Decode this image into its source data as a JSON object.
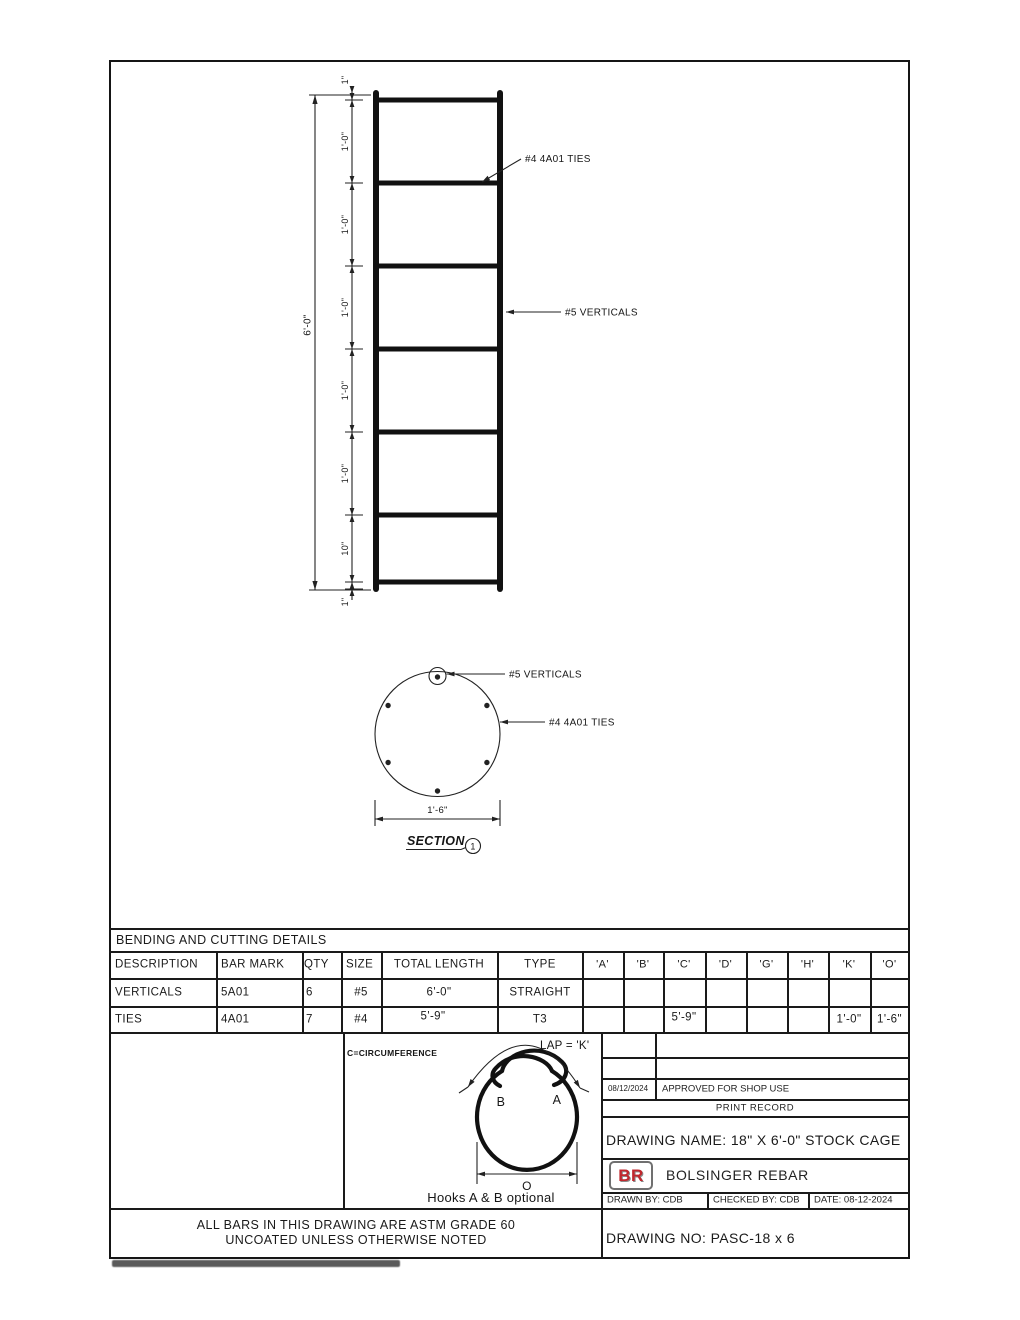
{
  "elevation": {
    "overall_dim": "6'-0\"",
    "dims": [
      "1\"",
      "1'-0\"",
      "1'-0\"",
      "1'-0\"",
      "1'-0\"",
      "1'-0\"",
      "10\"",
      "1\""
    ],
    "ties_label": "#4 4A01 TIES",
    "verticals_label": "#5 VERTICALS"
  },
  "section": {
    "verticals_label": "#5 VERTICALS",
    "ties_label": "#4 4A01 TIES",
    "width_dim": "1'-6\"",
    "title": "SECTION",
    "bubble": "1"
  },
  "bending_table": {
    "title": "BENDING AND CUTTING DETAILS",
    "columns": [
      "DESCRIPTION",
      "BAR MARK",
      "QTY",
      "SIZE",
      "TOTAL LENGTH",
      "TYPE",
      "'A'",
      "'B'",
      "'C'",
      "'D'",
      "'G'",
      "'H'",
      "'K'",
      "'O'"
    ],
    "rows": [
      {
        "desc": "VERTICALS",
        "mark": "5A01",
        "qty": "6",
        "size": "#5",
        "len": "6'-0\"",
        "type": "STRAIGHT"
      },
      {
        "desc": "TIES",
        "mark": "4A01",
        "qty": "7",
        "size": "#4",
        "len": "5'-9\"",
        "type": "T3",
        "c": "5'-9\"",
        "k": "1'-0\"",
        "o": "1'-6\""
      }
    ]
  },
  "hook_detail": {
    "circumference_note": "C=CIRCUMFERENCE",
    "lap_label": "LAP = 'K'",
    "hook_b": "B",
    "hook_a": "A",
    "diameter_label": "O",
    "caption": "Hooks A & B optional"
  },
  "title_block": {
    "print_record": {
      "date": "08/12/2024",
      "note": "APPROVED FOR SHOP USE",
      "label": "PRINT RECORD"
    },
    "drawing_name": "DRAWING NAME: 18\" X 6'-0\" STOCK CAGE",
    "logo_text": "BR",
    "company": "BOLSINGER REBAR",
    "drawn_by": "DRAWN BY: CDB",
    "checked_by": "CHECKED BY: CDB",
    "date": "DATE: 08-12-2024",
    "drawing_no": "DRAWING NO: PASC-18 x 6"
  },
  "notes": {
    "line1": "ALL BARS IN THIS DRAWING ARE ASTM GRADE 60",
    "line2": "UNCOATED UNLESS OTHERWISE NOTED"
  },
  "colors": {
    "line": "#1a1a1a",
    "logo_red": "#c1272d",
    "logo_border": "#707070"
  }
}
